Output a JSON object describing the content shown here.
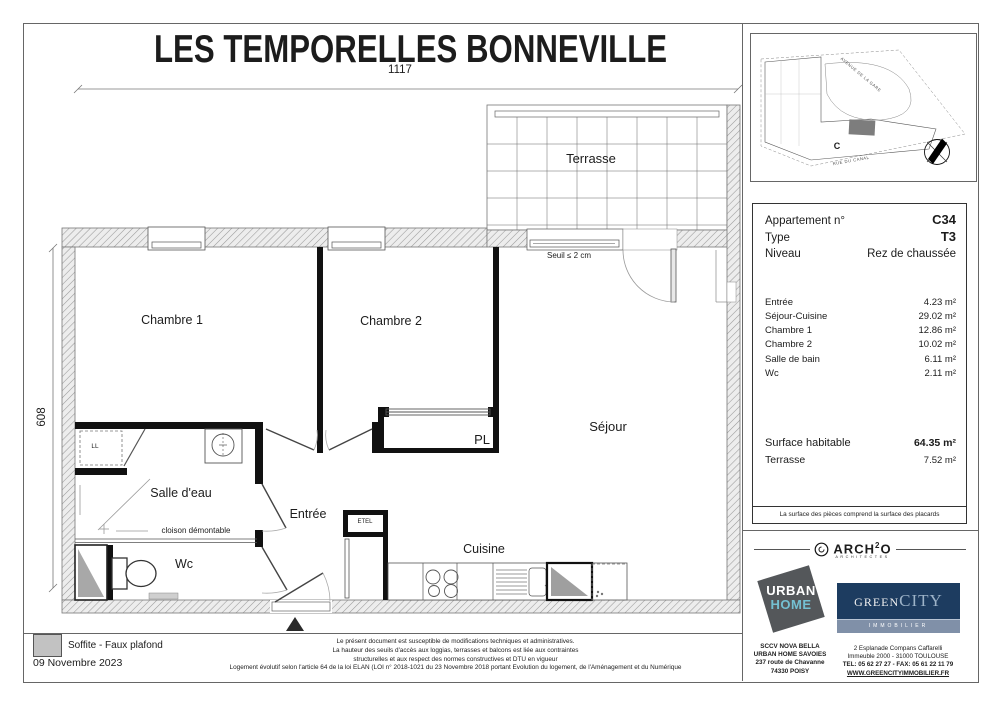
{
  "title": "LES TEMPORELLES BONNEVILLE",
  "dimensions": {
    "horizontal": "1117",
    "vertical": "608"
  },
  "plan": {
    "labels": {
      "terrasse": "Terrasse",
      "chambre1": "Chambre 1",
      "chambre2": "Chambre 2",
      "sejour": "Séjour",
      "salle_deau": "Salle d'eau",
      "entree": "Entrée",
      "wc": "Wc",
      "cuisine": "Cuisine",
      "pl": "PL",
      "ll": "LL",
      "etel": "ETEL"
    },
    "annotations": {
      "seuil": "Seuil ≤ 2 cm",
      "cloison": "cloison démontable"
    }
  },
  "site_plan": {
    "street_top": "AVENUE DE LA GARE",
    "street_bottom": "RUE DU CANAL",
    "building_label": "C"
  },
  "info_panel": {
    "apartment_label": "Appartement n°",
    "apartment_value": "C34",
    "type_label": "Type",
    "type_value": "T3",
    "level_label": "Niveau",
    "level_value": "Rez de chaussée",
    "rooms": [
      {
        "name": "Entrée",
        "area": "4.23 m²"
      },
      {
        "name": "Séjour-Cuisine",
        "area": "29.02 m²"
      },
      {
        "name": "Chambre 1",
        "area": "12.86 m²"
      },
      {
        "name": "Chambre 2",
        "area": "10.02 m²"
      },
      {
        "name": "Salle de bain",
        "area": "6.11 m²"
      },
      {
        "name": "Wc",
        "area": "2.11 m²"
      }
    ],
    "surface_label": "Surface habitable",
    "surface_value": "64.35 m²",
    "terrace_label": "Terrasse",
    "terrace_value": "7.52 m²",
    "note": "La surface des pièces comprend la surface des placards"
  },
  "legend": {
    "soffite": "Soffite - Faux plafond",
    "date": "09 Novembre 2023"
  },
  "disclaimer": {
    "line1": "Le présent document est susceptible de modifications techniques et administratives.",
    "line2": "La hauteur des seuils d'accès aux loggias, terrasses et balcons est liée aux contraintes",
    "line3": "structurelles et aux respect des normes constructives et DTU en vigueur",
    "line4": "Logement évolutif selon l'article 64 de la loi ELAN (LOI n° 2018-1021 du 23 Novembre 2018 portant Evolution du logement, de l'Aménagement et du Numérique"
  },
  "branding": {
    "architect": {
      "name_part1": "ARCH",
      "name_sup": "2",
      "name_part2": "O",
      "subtitle": "ARCHITECTES"
    },
    "urban_home": {
      "word1": "URBAN",
      "word2": "HOME",
      "address1": "SCCV NOVA BELLA",
      "address2": "URBAN HOME  SAVOIES",
      "address3": "237 route de Chavanne",
      "address4": "74330 POISY"
    },
    "greencity": {
      "word1": "GREEN",
      "word2": "CITY",
      "subtitle": "IMMOBILIER",
      "address1": "2 Esplanade Compans Caffarelli",
      "address2": "Immeuble 2000 - 31000 TOULOUSE",
      "address3": "TEL: 05 62 27 27 - FAX: 05 61 22 11 79",
      "address4": "WWW.GREENCITYIMMOBILIER.FR"
    }
  },
  "colors": {
    "wall": "#111111",
    "hatch_line": "#9a9a9a",
    "urban_home_bg": "#54575a",
    "urban_home_accent": "#74c0d2",
    "greencity_bg": "#1d3c60",
    "greencity_accent": "#9db3c8",
    "greencity_band": "#8090a8",
    "highlight_gray": "#a8a8a8"
  }
}
